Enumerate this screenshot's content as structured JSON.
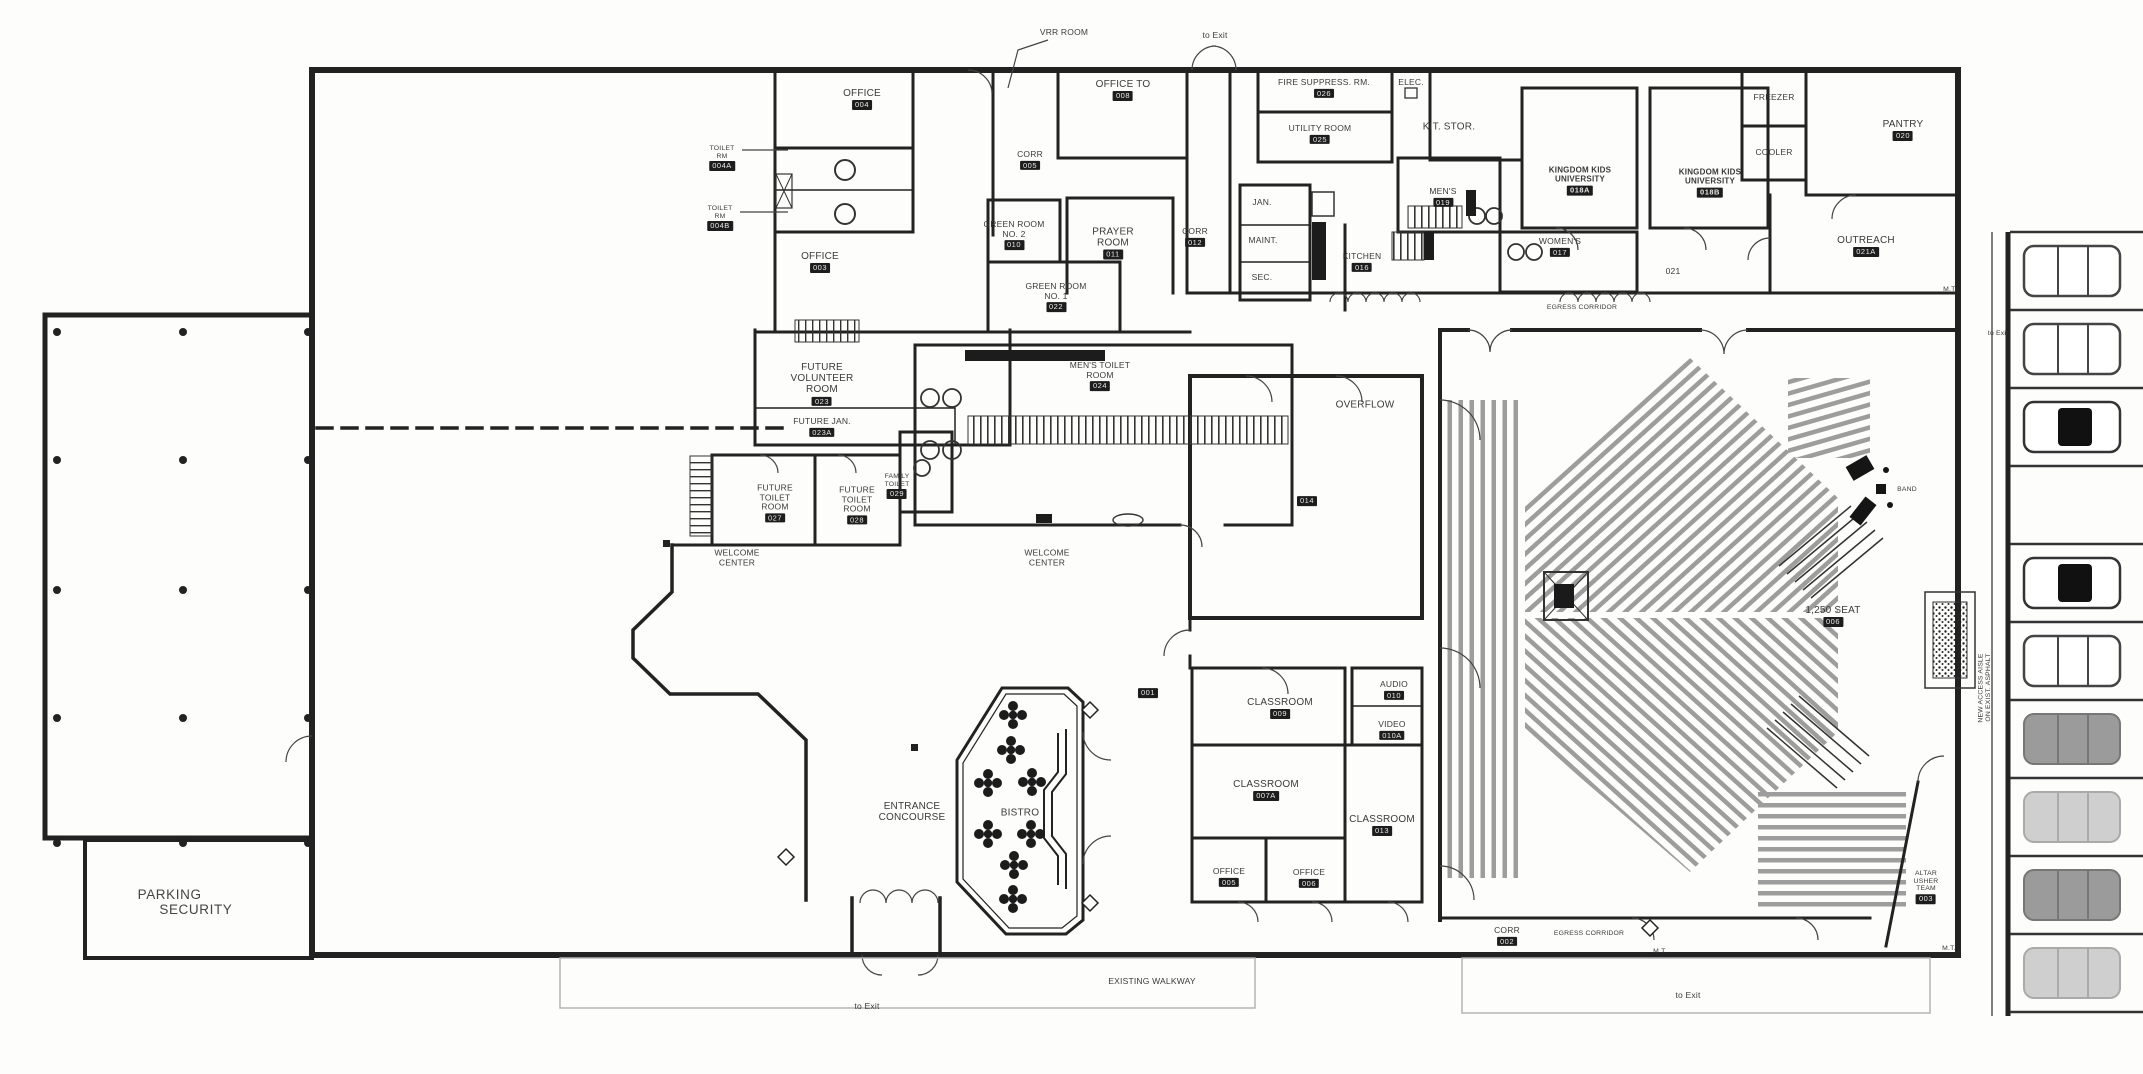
{
  "colors": {
    "wall": "#222222",
    "seat": "#9d9d9d",
    "paper": "#fdfdfc",
    "car_gray": "#9b9b9b"
  },
  "labels": {
    "vrr": {
      "text": "VRR ROOM"
    },
    "to_exit_top": {
      "text": "to Exit"
    },
    "to_exit_right": {
      "text": "to Exit"
    },
    "to_exit_bottom_left": {
      "text": "to Exit"
    },
    "to_exit_bottom_right": {
      "text": "to Exit"
    },
    "office_top": {
      "text": "OFFICE",
      "num": "004"
    },
    "toilet_a": {
      "text": "TOILET\nRM",
      "num": "004A"
    },
    "toilet_b": {
      "text": "TOILET\nRM",
      "num": "004B"
    },
    "office_to": {
      "text": "OFFICE TO",
      "num": "008"
    },
    "fire_suppress": {
      "text": "FIRE SUPPRESS. RM.",
      "num": "026"
    },
    "elec": {
      "text": "ELEC."
    },
    "utility": {
      "text": "UTILITY ROOM",
      "num": "025"
    },
    "kit_stor": {
      "text": "KIT. STOR."
    },
    "kku_a": {
      "text": "KINGDOM KIDS\nUNIVERSITY",
      "num": "018A"
    },
    "kku_b": {
      "text": "KINGDOM KIDS\nUNIVERSITY",
      "num": "018B"
    },
    "freezer": {
      "text": "FREEZER"
    },
    "cooler": {
      "text": "COOLER"
    },
    "pantry": {
      "text": "PANTRY",
      "num": "020"
    },
    "outreach": {
      "text": "OUTREACH",
      "num": "021A"
    },
    "corr_tl": {
      "text": "CORR",
      "num": "005"
    },
    "corr_mid": {
      "text": "CORR",
      "num": "012"
    },
    "corr_bot": {
      "text": "CORR",
      "num": "002"
    },
    "green2": {
      "text": "GREEN ROOM\nNO. 2",
      "num": "010"
    },
    "green1": {
      "text": "GREEN ROOM\nNO. 1",
      "num": "022"
    },
    "prayer": {
      "text": "PRAYER\nROOM",
      "num": "011"
    },
    "office_low": {
      "text": "OFFICE",
      "num": "003"
    },
    "jan": {
      "text": "JAN."
    },
    "maint": {
      "text": "MAINT."
    },
    "sec": {
      "text": "SEC."
    },
    "kitchen": {
      "text": "KITCHEN",
      "num": "016"
    },
    "mens_top": {
      "text": "MEN'S",
      "num": "019"
    },
    "womens": {
      "text": "WOMEN'S",
      "num": "017"
    },
    "egress_top": {
      "text": "EGRESS CORRIDOR"
    },
    "egress_bot": {
      "text": "EGRESS CORRIDOR"
    },
    "num_021": {
      "text": "021"
    },
    "num_001": {
      "num": "001"
    },
    "mt_top": {
      "text": "M.T."
    },
    "mt_bot1": {
      "text": "M.T."
    },
    "mt_bot2": {
      "text": "M.T."
    },
    "fut_vol": {
      "text": "FUTURE\nVOLUNTEER\nROOM",
      "num": "023"
    },
    "fut_jan": {
      "text": "FUTURE JAN.",
      "num": "023A"
    },
    "mens_toilet": {
      "text": "MEN'S TOILET\nROOM",
      "num": "024"
    },
    "overflow": {
      "text": "OVERFLOW",
      "num": "014"
    },
    "fut_toilet1": {
      "text": "FUTURE\nTOILET\nROOM",
      "num": "027"
    },
    "fut_toilet2": {
      "text": "FUTURE\nTOILET\nROOM",
      "num": "028"
    },
    "family_toilet": {
      "text": "FAMILY\nTOILET",
      "num": "029"
    },
    "welcome1": {
      "text": "WELCOME\nCENTER"
    },
    "welcome2": {
      "text": "WELCOME\nCENTER"
    },
    "cr009": {
      "text": "CLASSROOM",
      "num": "009"
    },
    "cr007a": {
      "text": "CLASSROOM",
      "num": "007A"
    },
    "cr013": {
      "text": "CLASSROOM",
      "num": "013"
    },
    "audio": {
      "text": "AUDIO",
      "num": "010"
    },
    "video": {
      "text": "VIDEO",
      "num": "010A"
    },
    "off005": {
      "text": "OFFICE",
      "num": "005"
    },
    "off006": {
      "text": "OFFICE",
      "num": "006"
    },
    "concourse": {
      "text": "ENTRANCE\nCONCOURSE"
    },
    "bistro": {
      "text": "BISTRO"
    },
    "band": {
      "text": "BAND"
    },
    "seat1250": {
      "text": "1,250 SEAT",
      "num": "006"
    },
    "access_aisle": {
      "text": "NEW ACCESS AISLE\nON EXIST. ASPHALT"
    },
    "altar": {
      "text": "ALTAR\nUSHER\nTEAM",
      "num": "003"
    },
    "walkway": {
      "text": "EXISTING WALKWAY"
    },
    "parking_sec": {
      "text": "PARKING\n     SECURITY"
    }
  }
}
